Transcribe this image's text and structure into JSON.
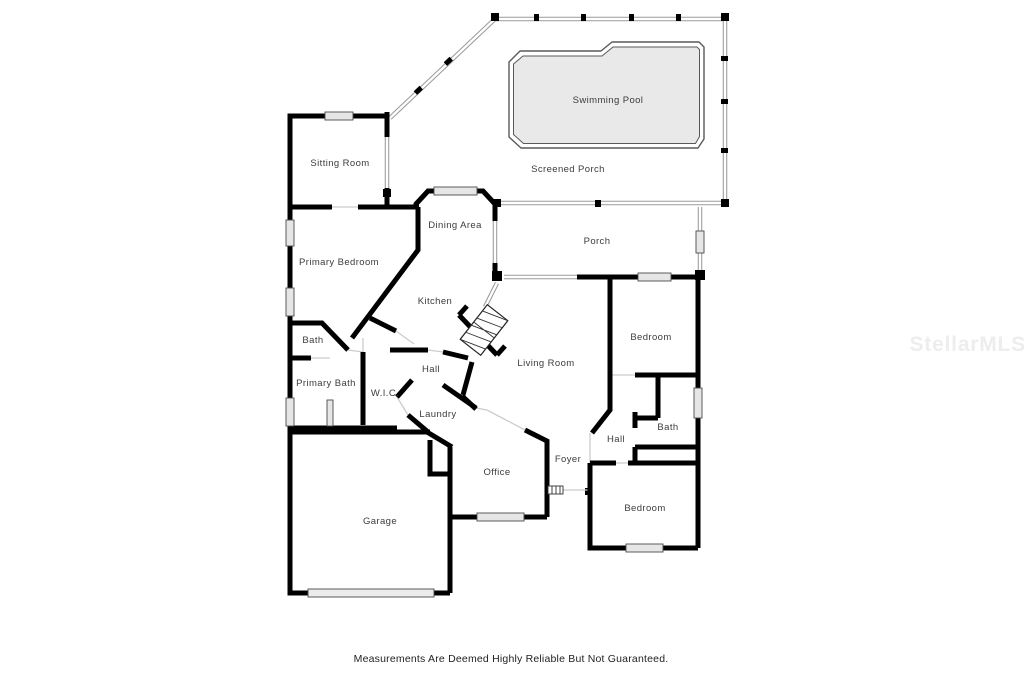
{
  "labels": {
    "swimming_pool": "Swimming Pool",
    "screened_porch": "Screened Porch",
    "sitting_room": "Sitting Room",
    "dining_area": "Dining Area",
    "porch": "Porch",
    "primary_bedroom": "Primary Bedroom",
    "kitchen": "Kitchen",
    "bedroom_right": "Bedroom",
    "bath_left": "Bath",
    "hall_center": "Hall",
    "primary_bath": "Primary Bath",
    "wic": "W.I.C.",
    "living_room": "Living Room",
    "laundry": "Laundry",
    "bath_right": "Bath",
    "hall_right": "Hall",
    "office": "Office",
    "foyer": "Foyer",
    "garage": "Garage",
    "bedroom_bottom": "Bedroom"
  },
  "footer": {
    "disclaimer": "Measurements Are Deemed Highly Reliable But Not Guaranteed."
  },
  "watermark": {
    "text": "StellarMLS",
    "color": "#ededed"
  },
  "colors": {
    "wall": "#000000",
    "screen_wall": "#9a9a9a",
    "pool_fill": "#e9e9e9",
    "pool_outline": "#595959",
    "window_fill": "#e6e6e6",
    "label_text": "#3c3c3c",
    "background": "#ffffff"
  }
}
